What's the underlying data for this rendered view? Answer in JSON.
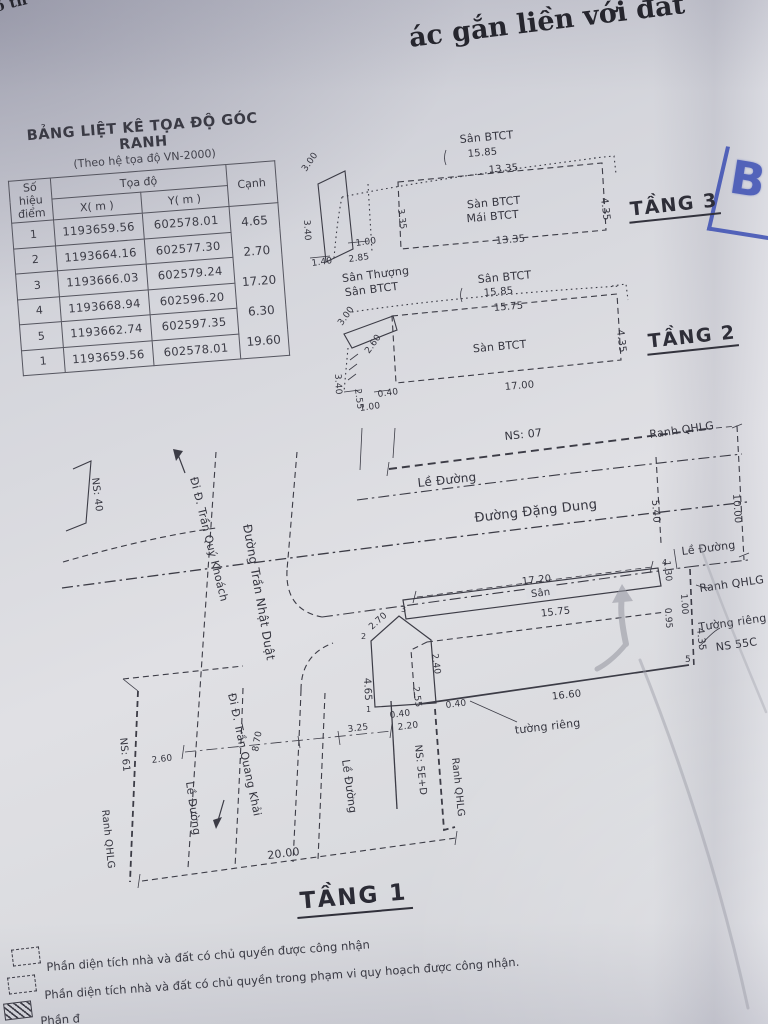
{
  "page": {
    "fragment_top_left": "ồ th",
    "title_fragment": "ác gắn liền với đất"
  },
  "stamp": {
    "letter": "B"
  },
  "coord_table": {
    "title": "BẢNG LIỆT KÊ TỌA ĐỘ GÓC RANH",
    "subtitle": "(Theo hệ tọa độ VN-2000)",
    "col_point_line1": "Số hiệu",
    "col_point_line2": "điểm",
    "col_coords": "Tọa độ",
    "col_x": "X( m )",
    "col_y": "Y( m )",
    "col_edge": "Cạnh",
    "rows": [
      {
        "point": "1",
        "x": "1193659.56",
        "y": "602578.01"
      },
      {
        "point": "2",
        "x": "1193664.16",
        "y": "602577.30"
      },
      {
        "point": "3",
        "x": "1193666.03",
        "y": "602579.24"
      },
      {
        "point": "4",
        "x": "1193668.94",
        "y": "602596.20"
      },
      {
        "point": "5",
        "x": "1193662.74",
        "y": "602597.35"
      },
      {
        "point": "1",
        "x": "1193659.56",
        "y": "602578.01"
      }
    ],
    "edges": [
      "4.65",
      "2.70",
      "17.20",
      "6.30",
      "19.60"
    ]
  },
  "floor3": {
    "label": "TẦNG 3",
    "roof_label": "Sân BTCT",
    "dim_top_outer": "15.85",
    "dim_top": "13.35",
    "inner_label1": "Sàn BTCT",
    "inner_label2": "Mái BTCT",
    "dim_right": "4.35",
    "dim_bottom": "13.35",
    "dim_slant": "3.00",
    "dim_left": "3.40",
    "dim_left_inner": "3.35",
    "dim_b1": "1.40",
    "dim_b2": "2.85",
    "dim_b3": "1.00",
    "terrace_label1": "Sân Thượng",
    "terrace_label2": "Sân BTCT"
  },
  "floor2": {
    "label": "TẦNG 2",
    "roof_label": "Sân BTCT",
    "dim_top_outer": "15.85",
    "dim_top": "15.75",
    "inner_label": "Sàn BTCT",
    "dim_right": "4.35",
    "dim_bottom": "17.00",
    "dim_slant": "3.00",
    "dim_slant2": "2.60",
    "dim_left": "3.40",
    "dim_left2": "2.55",
    "dim_s1": "0.40",
    "dim_s2": "1.00"
  },
  "site": {
    "ns07": "NS: 07",
    "ns40": "NS: 40",
    "ns61": "NS: 61",
    "ns5ed": "NS: 5E+D",
    "ns55c": "NS 55C",
    "ranh_qhlg": "Ranh QHLG",
    "le_duong": "Lề Đường",
    "street_dang_dung": "Đường Đặng Dung",
    "street_tran_nhat_duat": "Đường Trần Nhật Duật",
    "street_tran_quy_khoach": "Đi Đ. Trần Quý Khoách",
    "street_tran_quang_khai": "Đi Đ. Trần Quang Khải",
    "wall_label": "Tường riêng",
    "wall_label_2": "tường riêng",
    "san_label": "Sân",
    "dims": {
      "top": "17.20",
      "top_inner": "15.75",
      "slant": "2.70",
      "left": "4.65",
      "v1": "2.40",
      "v2": "2.55",
      "s1": "0.40",
      "s2": "0.40",
      "b1": "2.20",
      "b2": "3.25",
      "b3": "8.70",
      "wall_bottom": "16.60",
      "street": "20.00",
      "left_small": "2.60",
      "r_sidewalk": "5.40",
      "r_qhlg": "10.00",
      "r1": "1.30",
      "r2": "1.00",
      "r3": "0.95",
      "r4": "4.35"
    },
    "points": {
      "p1": "1",
      "p2": "2",
      "p3": "3",
      "p4": "4",
      "p5": "5"
    }
  },
  "floor1": {
    "label": "TẦNG 1"
  },
  "legend": {
    "items": [
      "Phần diện tích nhà và đất có chủ quyền được công nhận",
      "Phần diện tích nhà và đất có chủ quyền trong phạm vi quy hoạch được công nhận.",
      "Phần đ"
    ]
  }
}
